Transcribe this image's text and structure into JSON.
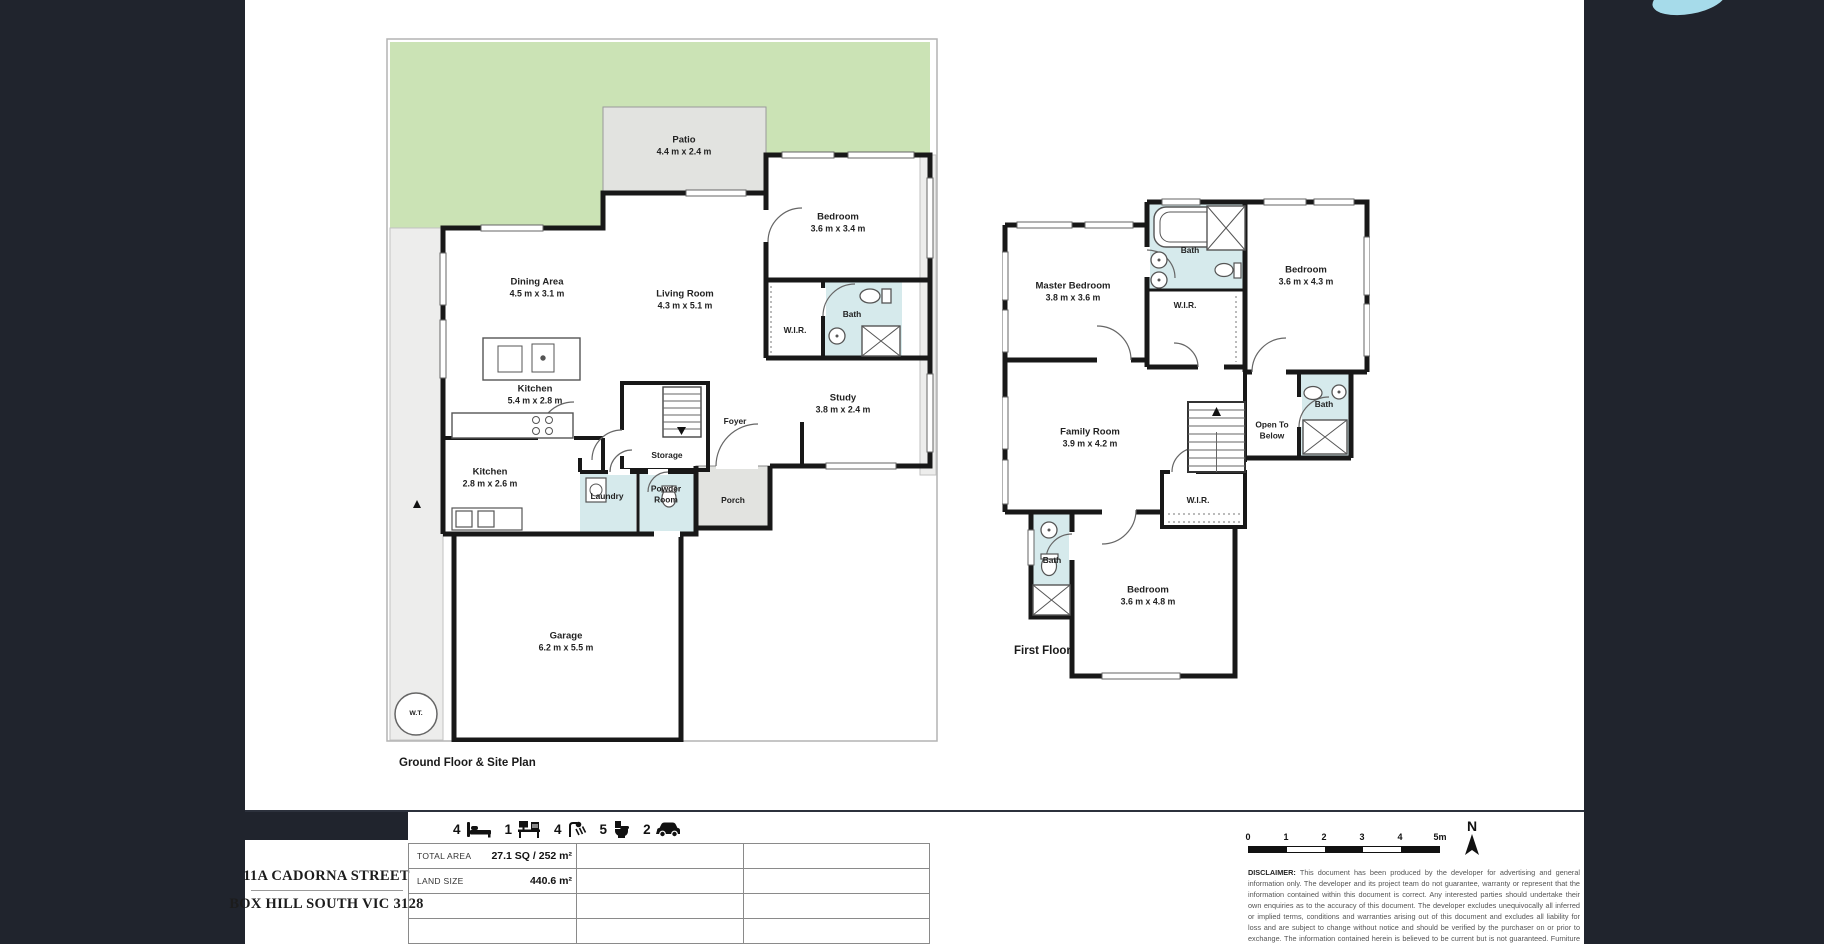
{
  "plan_labels": {
    "ground": "Ground Floor & Site Plan",
    "first": "First Floor"
  },
  "ground_rooms": [
    {
      "n": "Patio",
      "d": "4.4 m x 2.4 m",
      "x": 298,
      "y": 108
    },
    {
      "n": "Dining Area",
      "d": "4.5 m x 3.1 m",
      "x": 151,
      "y": 250
    },
    {
      "n": "Living Room",
      "d": "4.3 m x 5.1 m",
      "x": 299,
      "y": 262
    },
    {
      "n": "Bedroom",
      "d": "3.6 m x 3.4 m",
      "x": 452,
      "y": 185
    },
    {
      "n": "W.I.R.",
      "x": 409,
      "y": 292,
      "s": "sm"
    },
    {
      "n": "Bath",
      "x": 466,
      "y": 276,
      "s": "sm"
    },
    {
      "n": "Study",
      "d": "3.8 m x 2.4 m",
      "x": 457,
      "y": 366
    },
    {
      "n": "Kitchen",
      "d": "5.4 m x 2.8 m",
      "x": 149,
      "y": 357
    },
    {
      "n": "Kitchen",
      "d": "2.8 m x 2.6 m",
      "x": 104,
      "y": 440
    },
    {
      "n": "Storage",
      "x": 281,
      "y": 417,
      "s": "sm"
    },
    {
      "n": "Foyer",
      "x": 349,
      "y": 383,
      "s": "sm"
    },
    {
      "n": "Laundry",
      "x": 221,
      "y": 458,
      "s": "sm"
    },
    {
      "n": "Powder\nRoom",
      "x": 280,
      "y": 456,
      "s": "sm"
    },
    {
      "n": "Porch",
      "x": 347,
      "y": 462,
      "s": "sm"
    },
    {
      "n": "Garage",
      "d": "6.2 m x 5.5 m",
      "x": 180,
      "y": 604
    },
    {
      "n": "W.T.",
      "x": 30,
      "y": 676,
      "s": "xs"
    }
  ],
  "first_rooms": [
    {
      "n": "Master Bedroom",
      "d": "3.8 m x 3.6 m",
      "x": 71,
      "y": 100
    },
    {
      "n": "Bath",
      "x": 188,
      "y": 58,
      "s": "sm"
    },
    {
      "n": "W.I.R.",
      "x": 183,
      "y": 113,
      "s": "sm"
    },
    {
      "n": "Bedroom",
      "d": "3.6 m x 4.3 m",
      "x": 304,
      "y": 84
    },
    {
      "n": "Family Room",
      "d": "3.9 m x 4.2 m",
      "x": 88,
      "y": 246
    },
    {
      "n": "Open To\nBelow",
      "x": 270,
      "y": 238,
      "s": "sm"
    },
    {
      "n": "Bath",
      "x": 322,
      "y": 212,
      "s": "sm"
    },
    {
      "n": "W.I.R.",
      "x": 196,
      "y": 308,
      "s": "sm"
    },
    {
      "n": "Bath",
      "x": 50,
      "y": 368,
      "s": "sm"
    },
    {
      "n": "Bedroom",
      "d": "3.6 m x 4.8 m",
      "x": 146,
      "y": 404
    }
  ],
  "footer": {
    "address_line1": "11A CADORNA STREET",
    "address_line2": "BOX HILL SOUTH VIC 3128",
    "features": [
      {
        "icon": "bed-icon",
        "count": "4"
      },
      {
        "icon": "desk-icon",
        "count": "1"
      },
      {
        "icon": "shower-icon",
        "count": "4"
      },
      {
        "icon": "toilet-icon",
        "count": "5"
      },
      {
        "icon": "car-icon",
        "count": "2"
      }
    ],
    "stats": [
      {
        "label": "TOTAL AREA",
        "value": "27.1 SQ /  252  m²"
      },
      {
        "label": "LAND SIZE",
        "value": "440.6  m²"
      }
    ],
    "scale": {
      "ticks": [
        "0",
        "1",
        "2",
        "3",
        "4",
        "5m"
      ]
    },
    "north_label": "N",
    "disclaimer_bold": "DISCLAIMER:",
    "disclaimer_text": " This document has been produced by the developer for advertising and general information only. The developer and its project team do not guarantee, warranty or represent that the information contained within this document is correct. Any interested parties should undertake their own enquiries as to the accuracy of this document. The developer excludes unequivocally all inferred or implied terms, conditions and warranties arising out of this document and excludes all liability for loss and are subject to change without notice and should be verified by the purchaser on or prior to exchange. The information contained herein is believed to be current but is not guaranteed. Furniture is not included."
  }
}
